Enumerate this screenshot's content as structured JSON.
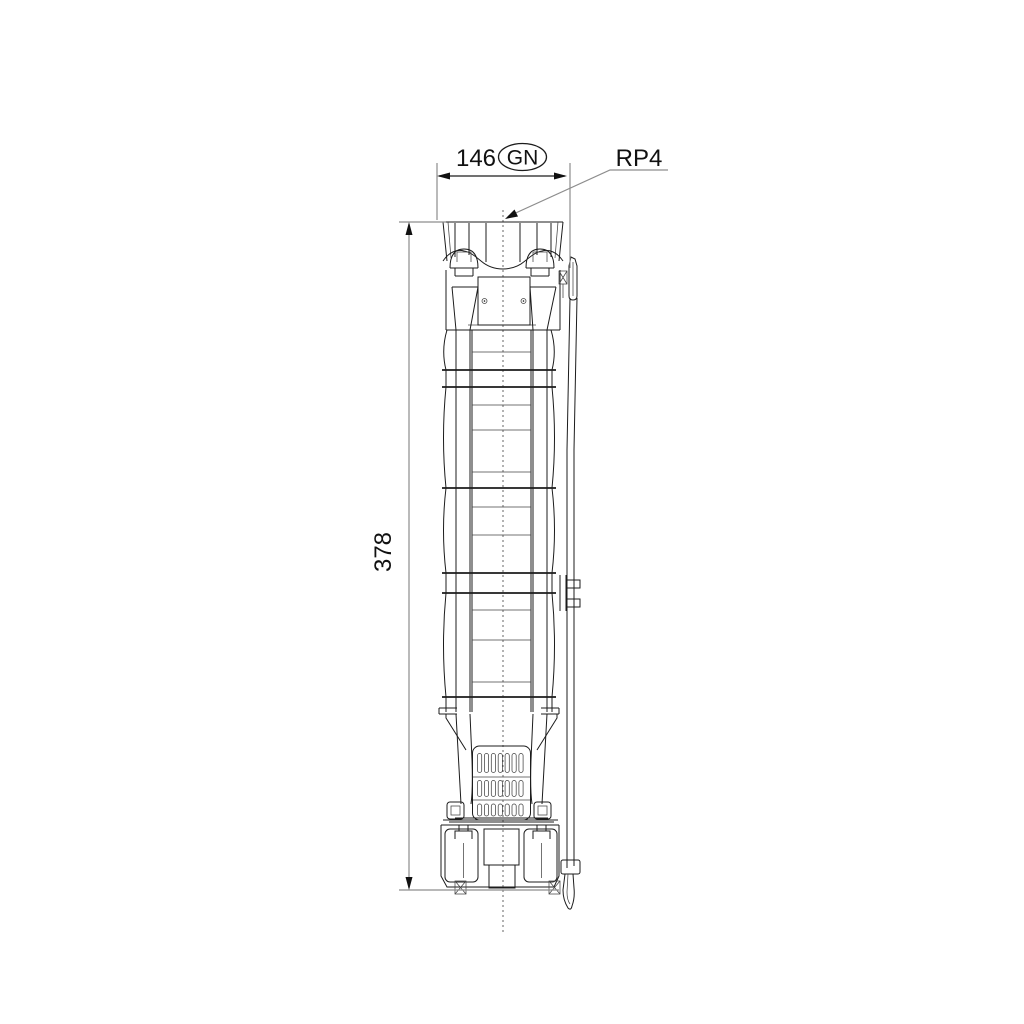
{
  "drawing": {
    "width_dim": {
      "value": "146",
      "tag": "GN"
    },
    "height_dim": {
      "value": "378"
    },
    "thread_label": "RP4",
    "colors": {
      "line": "#1c1c1c",
      "dimension_line": "#8d8d8d",
      "background": "#ffffff",
      "text": "#111111"
    }
  }
}
